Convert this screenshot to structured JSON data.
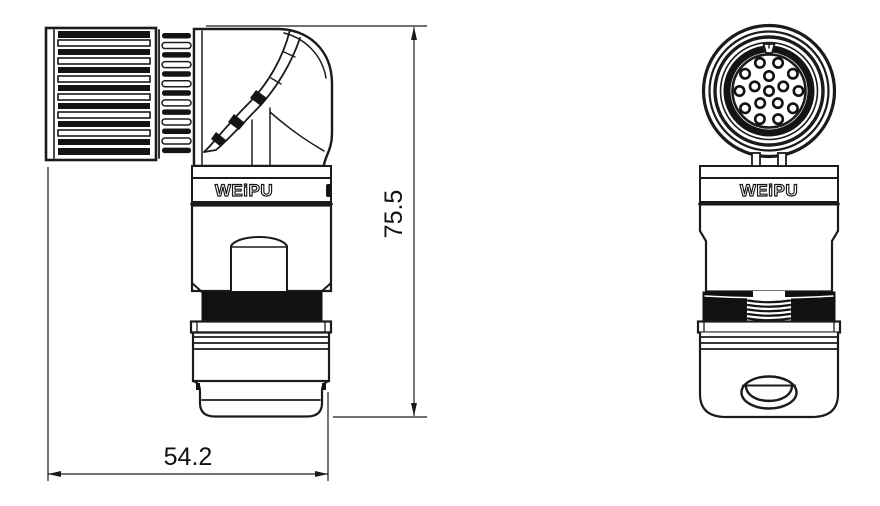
{
  "drawing": {
    "kind": "connector_technical_drawing",
    "dimensions": {
      "height_label": "75.5",
      "width_label": "54.2"
    },
    "views": {
      "side": {
        "brand_label": "WEiPU"
      },
      "front": {
        "brand_label": "WEiPU",
        "pin_count": 16,
        "pin_rings": [
          {
            "count": 10,
            "radius": 29.5,
            "start_deg": -72
          },
          {
            "count": 5,
            "radius": 15,
            "start_deg": -90
          },
          {
            "count": 1,
            "radius": 0,
            "start_deg": 0
          }
        ]
      }
    },
    "colors": {
      "line": "#1b1b1b",
      "background": "#ffffff",
      "thread_fill": "#111111"
    }
  }
}
